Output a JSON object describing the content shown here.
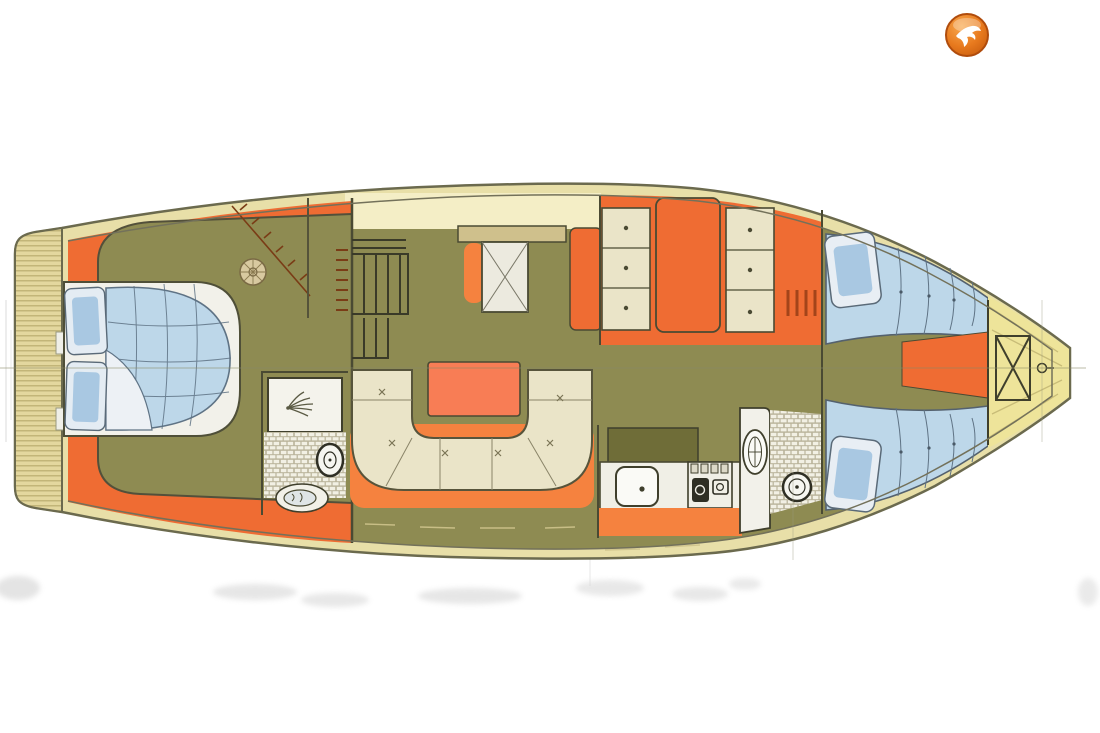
{
  "page": {
    "background": "#ffffff",
    "kind": "yacht-interior-deck-plan-scan"
  },
  "logo": {
    "icon": "falcon-logo-icon",
    "outer": "#e87a1e",
    "highlight": "#f8a94f",
    "shadow": "#c65a0d",
    "ring": "#b04c0c",
    "bird": "#ffffff"
  },
  "plan": {
    "colors": {
      "outline_dark": "#44442f",
      "hull_stroke": "#6b6a4e",
      "inner_line": "#73715a",
      "side_deck_tan": "#e8dfa8",
      "cockpit_cream": "#f4eec6",
      "bow_yellow": "#eee49a",
      "platform_teak": "#e3d79e",
      "platform_stripe": "#b7aa6c",
      "deck_orange": "#ef6c33",
      "accent_orange": "#f5823f",
      "table_orange": "#f87d55",
      "floor_olive": "#8e8b52",
      "counter_olive": "#6f6d38",
      "upholstery_cream": "#eae4c8",
      "fixture_white": "#f4f3ea",
      "mattress_blue": "#bdd7e9",
      "pillow_blue": "#a9c8e2",
      "duvet_fold_white": "#edf1f5",
      "quilt_line": "#5f7385",
      "centerline": "#8a8a66",
      "steps_mark": "#7a3c16",
      "smudge": "#b9b9b9"
    },
    "areas": [
      "swim-platform",
      "aft-cabin",
      "aft-double-berth",
      "aft-head-shower",
      "aft-head-toilet",
      "aft-head-washbasin",
      "companionway-stairs",
      "cockpit",
      "salon-u-settee",
      "salon-table",
      "nav-seat",
      "wardrobe-drawers",
      "hanging-locker",
      "galley-counter",
      "galley-sink",
      "galley-stove",
      "forward-head-washbasin",
      "forward-head-toilet",
      "forward-cabin-port-berth",
      "forward-cabin-starboard-berth",
      "forepeak-infill",
      "anchor-locker",
      "bow-deck"
    ]
  }
}
